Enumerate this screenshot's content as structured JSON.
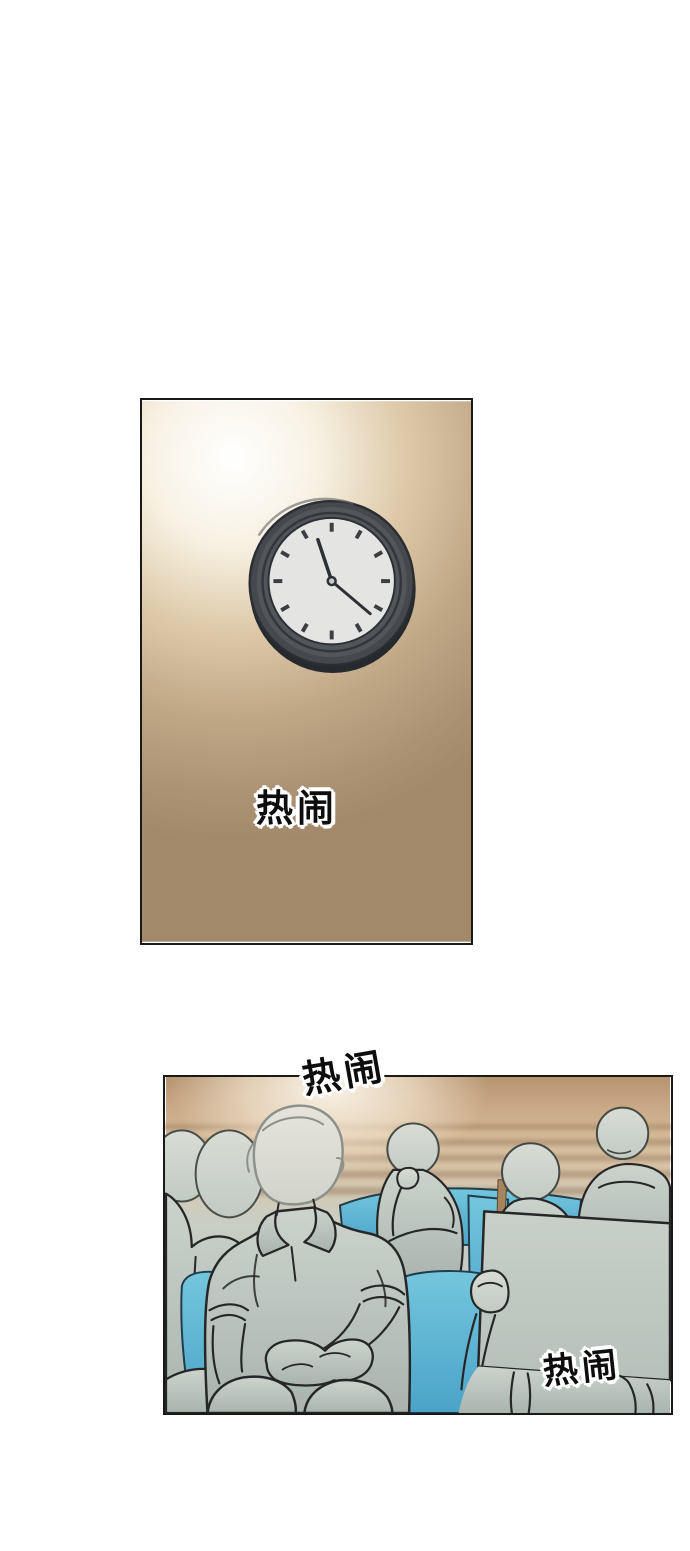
{
  "page": {
    "background": "#ffffff"
  },
  "panels": [
    {
      "name": "clock-wall-panel",
      "sfx": [
        {
          "text": "热闹"
        }
      ],
      "colors": {
        "wall_highlight": "#ffffff",
        "wall_tan": "#a18969",
        "clock_rim": "#45494d",
        "clock_face": "#e4e5e3",
        "clock_hands": "#2d3135"
      }
    },
    {
      "name": "audience-panel",
      "sfx": [
        {
          "text": "热闹"
        },
        {
          "text": "热闹"
        }
      ],
      "colors": {
        "background_tan": "#c9a885",
        "glow": "#fdf8ec",
        "figure_fill": "#c5cdc7",
        "chair_blue": "#5fb4d3",
        "outline": "#262626"
      }
    }
  ]
}
